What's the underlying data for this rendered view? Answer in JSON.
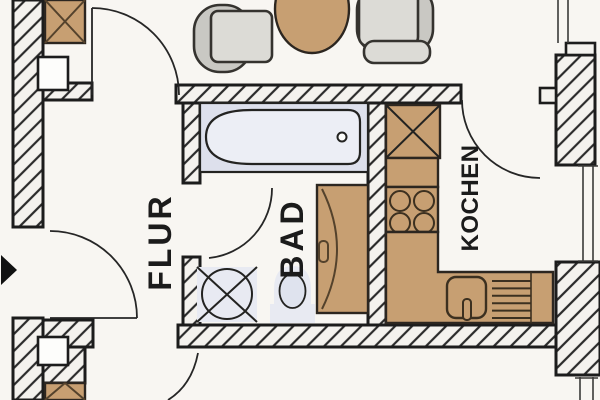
{
  "title": "Apartment floor plan",
  "labels": {
    "hall": "FLUR",
    "bath": "BAD",
    "kitchen": "KOCHEN"
  },
  "colors": {
    "background": "#fbfaf7",
    "floor": "#f8f6f2",
    "line": "#1c1c1c",
    "wall_fill": "#f4f2ee",
    "wood": "#c79f72",
    "wood_dark": "#54422c",
    "upholstery": "#c9c8c3",
    "seat": "#dcdbd6",
    "ceramic": "#e8eaf2",
    "tub": "#dde0ec",
    "text": "#1b1b1b"
  },
  "fixtures": [
    "wardrobe-top-left",
    "wall-shaft-upper",
    "armchair-left",
    "dining-table",
    "armchair-right",
    "bathtub",
    "washing-machine",
    "toilet",
    "vanity-basin",
    "tall-cabinet",
    "base-cabinet",
    "cooktop",
    "kitchen-sink",
    "dish-drainer",
    "entry-arrow",
    "wall-shaft-lower",
    "wardrobe-bottom-left"
  ]
}
